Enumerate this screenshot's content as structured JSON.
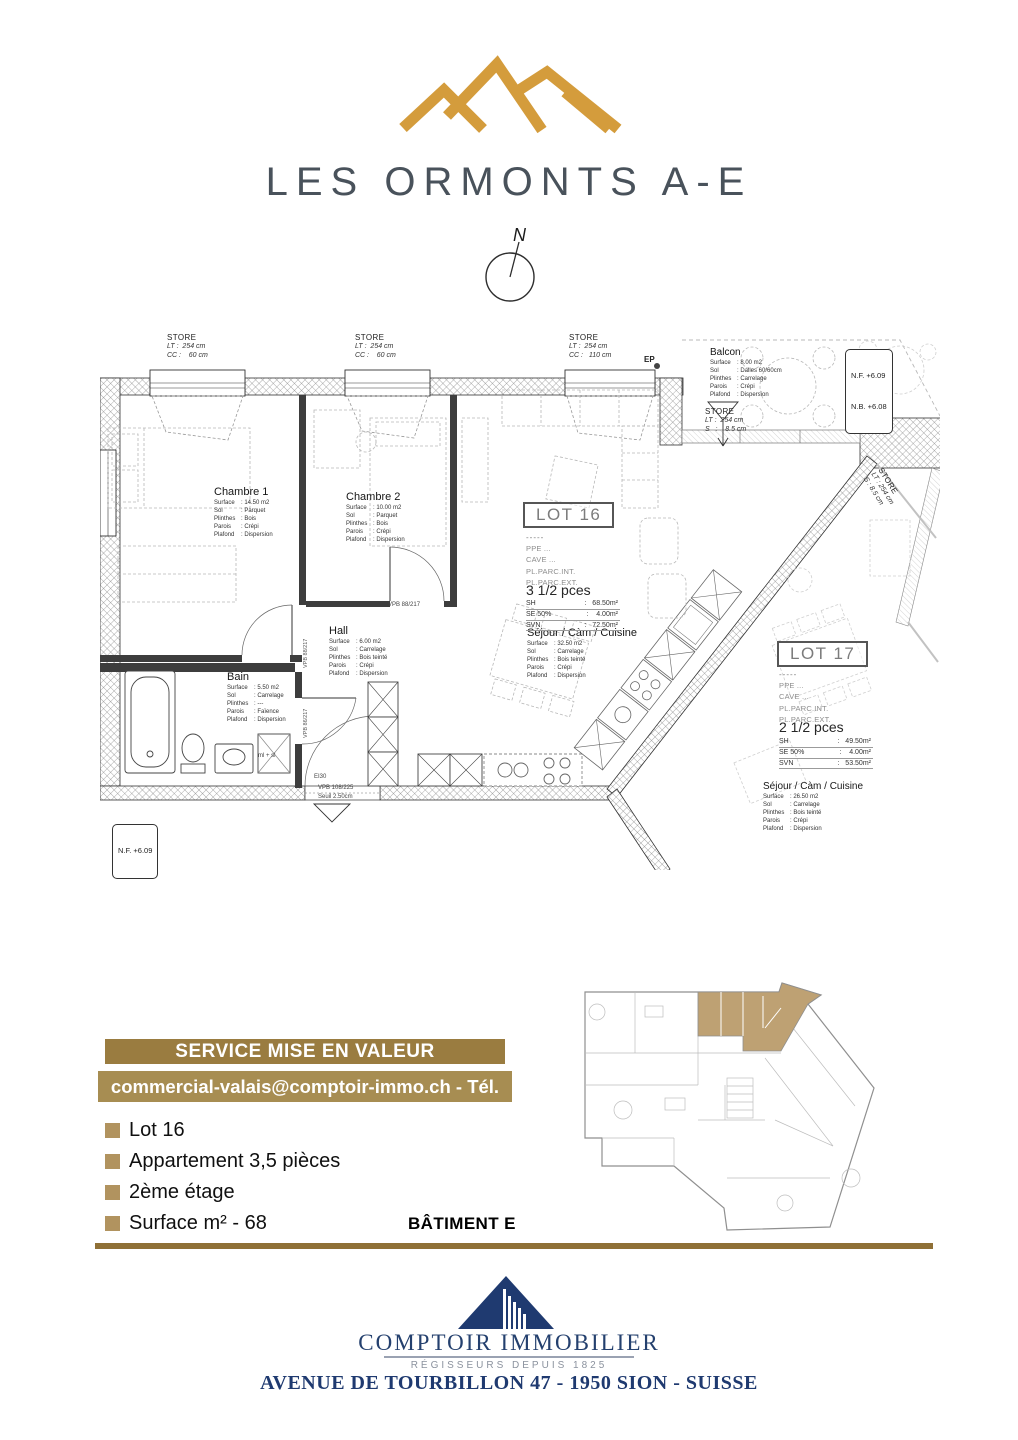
{
  "logo": {
    "title": "LES ORMONTS A-E",
    "accent_color": "#D49C3C",
    "title_color": "#49525B"
  },
  "compass": {
    "n": "N"
  },
  "plan": {
    "stores": [
      {
        "name": "STORE",
        "lines": [
          "LT :  254 cm",
          "CC :    60 cm"
        ]
      },
      {
        "name": "STORE",
        "lines": [
          "LT :  254 cm",
          "CC :    60 cm"
        ]
      },
      {
        "name": "STORE",
        "lines": [
          "LT :  254 cm",
          "CC :   110 cm"
        ]
      },
      {
        "name": "STORE",
        "lines": [
          "LT :  254 cm",
          "S   :    8.5 cm"
        ]
      },
      {
        "name": "STORE",
        "lines": [
          "LT : 254 cm",
          "S : 8.5 cm"
        ]
      }
    ],
    "ep": "EP",
    "levels": {
      "nf": "N.F. +6.09",
      "nb": "N.B. +6.08",
      "nf_left": "N.F. +6.09"
    },
    "rooms": [
      {
        "name": "Chambre 1",
        "specs": [
          {
            "k": "Surface",
            "v": ": 14.50 m2"
          },
          {
            "k": "Sol",
            "v": ": Parquet"
          },
          {
            "k": "Plinthes",
            "v": ": Bois"
          },
          {
            "k": "Parois",
            "v": ": Crépi"
          },
          {
            "k": "Plafond",
            "v": ": Dispersion"
          }
        ]
      },
      {
        "name": "Chambre 2",
        "specs": [
          {
            "k": "Surface",
            "v": ": 10.00 m2"
          },
          {
            "k": "Sol",
            "v": ": Parquet"
          },
          {
            "k": "Plinthes",
            "v": ": Bois"
          },
          {
            "k": "Parois",
            "v": ": Crépi"
          },
          {
            "k": "Plafond",
            "v": ": Dispersion"
          }
        ]
      },
      {
        "name": "Hall",
        "specs": [
          {
            "k": "Surface",
            "v": ": 6.00 m2"
          },
          {
            "k": "Sol",
            "v": ": Carrelage"
          },
          {
            "k": "Plinthes",
            "v": ": Bois teinté"
          },
          {
            "k": "Parois",
            "v": ": Crépi"
          },
          {
            "k": "Plafond",
            "v": ": Dispersion"
          }
        ]
      },
      {
        "name": "Bain",
        "specs": [
          {
            "k": "Surface",
            "v": ": 5.50 m2"
          },
          {
            "k": "Sol",
            "v": ": Carrelage"
          },
          {
            "k": "Plinthes",
            "v": ": ---"
          },
          {
            "k": "Parois",
            "v": ": Faïence"
          },
          {
            "k": "Plafond",
            "v": ": Dispersion"
          }
        ]
      },
      {
        "name": "Séjour / Càm / Cuisine",
        "specs": [
          {
            "k": "Surface",
            "v": ": 32.50 m2"
          },
          {
            "k": "Sol",
            "v": ": Carrelage"
          },
          {
            "k": "Plinthes",
            "v": ": Bois teinté"
          },
          {
            "k": "Parois",
            "v": ": Crépi"
          },
          {
            "k": "Plafond",
            "v": ": Dispersion"
          }
        ]
      },
      {
        "name": "Balcon",
        "specs": [
          {
            "k": "Surface",
            "v": ": 8.00 m2"
          },
          {
            "k": "Sol",
            "v": ": Dalles 60/60cm"
          },
          {
            "k": "Plinthes",
            "v": ": Carrelage"
          },
          {
            "k": "Parois",
            "v": ": Crépi"
          },
          {
            "k": "Plafond",
            "v": ": Dispersion"
          }
        ]
      },
      {
        "name": "Séjour / Càm / Cuisine",
        "specs": [
          {
            "k": "Surface",
            "v": ": 26.50 m2"
          },
          {
            "k": "Sol",
            "v": ": Carrelage"
          },
          {
            "k": "Plinthes",
            "v": ": Bois teinté"
          },
          {
            "k": "Parois",
            "v": ": Crépi"
          },
          {
            "k": "Plafond",
            "v": ": Dispersion"
          }
        ]
      }
    ],
    "lots": [
      {
        "title": "LOT 16",
        "dash": "-----",
        "items": [
          "PPE  ...",
          "CAVE  ...",
          "PL.PARC.INT.",
          "PL.PARC.EXT."
        ],
        "pces": "3 1/2 pces",
        "metrics": [
          {
            "k": "SH",
            "v": ":   68.50m²"
          },
          {
            "k": "SE 50%",
            "v": ":    4.00m²"
          },
          {
            "k": "SVN",
            "v": ":   72.50m²"
          }
        ]
      },
      {
        "title": "LOT 17",
        "dash": "-----",
        "items": [
          "PPE  ...",
          "CAVE  ...",
          "PL.PARC.INT.",
          "PL.PARC.EXT."
        ],
        "pces": "2 1/2 pces",
        "metrics": [
          {
            "k": "SH",
            "v": ":   49.50m²"
          },
          {
            "k": "SE 50%",
            "v": ":    4.00m²"
          },
          {
            "k": "SVN",
            "v": ":   53.50m²"
          }
        ]
      }
    ],
    "marks": {
      "ei30": "EI30",
      "vpb_door": "VPB 108/225",
      "seuil": "Seuil 2.50cm",
      "vpb_a": "VPB 88/217",
      "vpb_b": "VPB 86/217",
      "vpb_c": "VPB 88/217",
      "mlsl": "ml + sl"
    }
  },
  "banner": {
    "title": "SERVICE MISE EN VALEUR",
    "contact": "commercial-valais@comptoir-immo.ch - Tél. +4127 345 23 02",
    "bar1_color": "#9A7C40",
    "bar2_color": "#A78D52"
  },
  "details": {
    "items": [
      "Lot 16",
      "Appartement 3,5 pièces",
      "2ème étage",
      "Surface m² - 68"
    ],
    "bullet_color": "#B1935F",
    "batiment": "BÂTIMENT E",
    "highlight_color": "#BEA173"
  },
  "footer": {
    "company": "COMPTOIR IMMOBILIER",
    "tagline": "RÉGISSEURS DEPUIS 1825",
    "address": "AVENUE DE TOURBILLON 47 - 1950 SION - SUISSE",
    "navy": "#1F3A70"
  }
}
